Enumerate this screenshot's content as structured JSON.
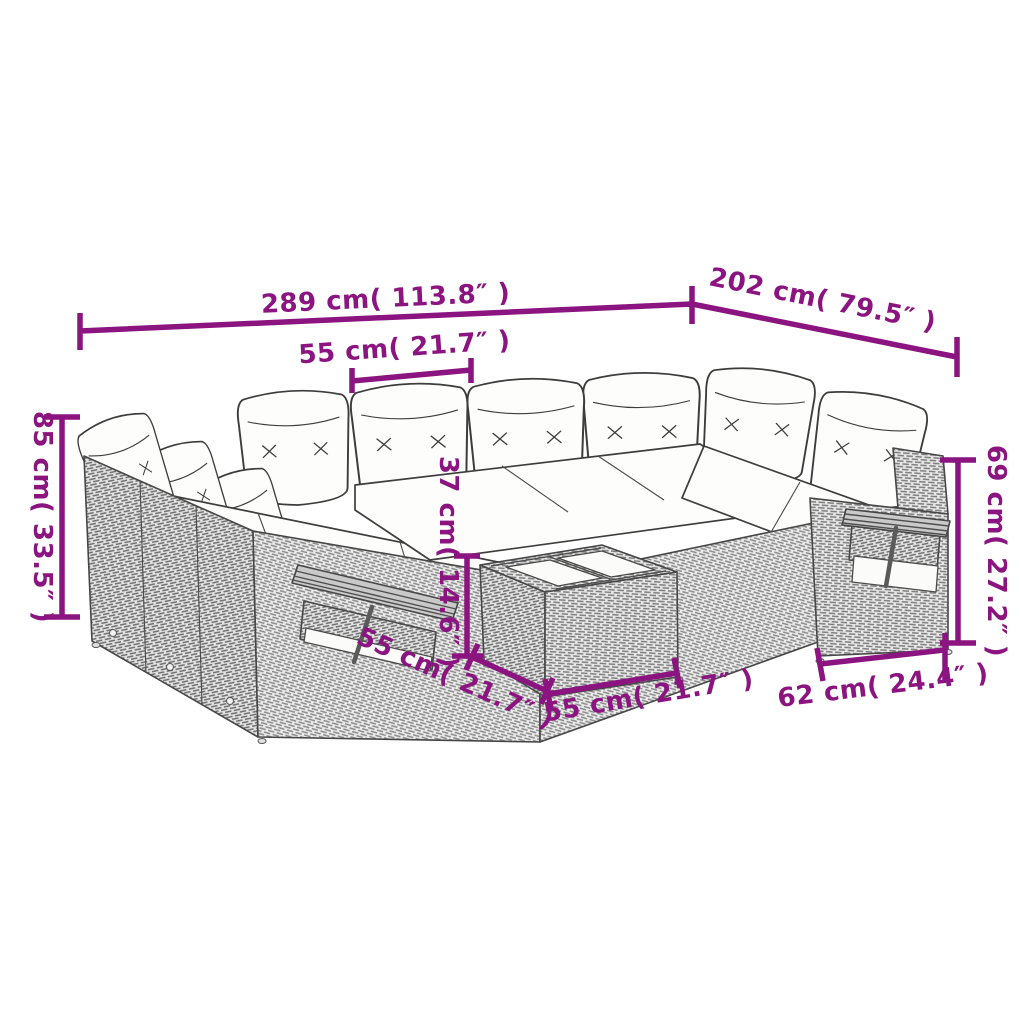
{
  "diagram": {
    "type": "product-dimension-diagram",
    "subject": "rattan garden sofa set with coffee table",
    "background_color": "#ffffff",
    "accent_color": "#8B1480",
    "line_color": "#3d3d3d",
    "dimensions": [
      {
        "name": "overall-width",
        "label": "289 cm( 113.8″ )"
      },
      {
        "name": "overall-depth",
        "label": "202 cm( 79.5″ )"
      },
      {
        "name": "seat-width",
        "label": "55 cm( 21.7″ )"
      },
      {
        "name": "overall-height",
        "label": "85 cm( 33.5″ )"
      },
      {
        "name": "backrest-height",
        "label": "69 cm( 27.2″ )"
      },
      {
        "name": "table-height",
        "label": "37 cm( 14.6″ )"
      },
      {
        "name": "table-depth",
        "label": "55 cm( 21.7″ )"
      },
      {
        "name": "table-width",
        "label": "55 cm( 21.7″ )"
      },
      {
        "name": "seat-depth",
        "label": "62 cm( 24.4″ )"
      }
    ]
  }
}
